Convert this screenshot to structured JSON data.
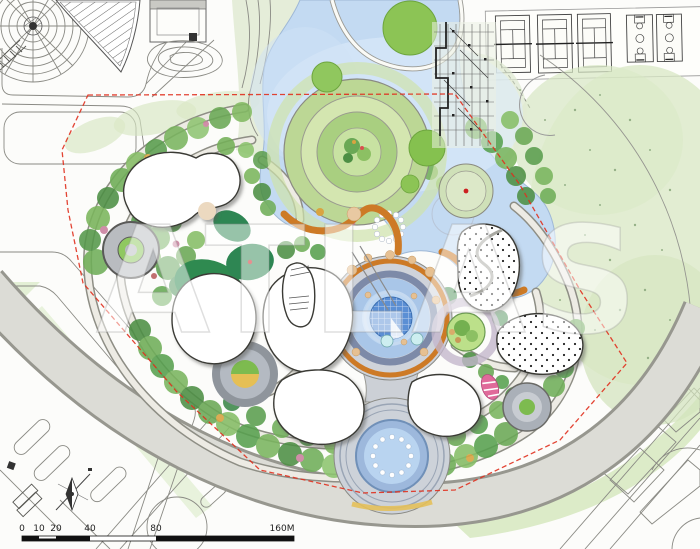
{
  "watermark": {
    "text": "ATLAS"
  },
  "scalebar": {
    "labels": [
      "0",
      "10",
      "20",
      "40",
      "80",
      "160M"
    ]
  },
  "colors": {
    "pond": "#c3daf2",
    "pond_highlight": "#dcebfa",
    "boardwalk": "#cd7a26",
    "boundary": "#e0301e",
    "dome_water": "#5b8fd4",
    "lawn_wash": "#d8e7c4",
    "promenade": "#dcdcd6",
    "dark_lawn": "#2e8653"
  },
  "features": {
    "sports_courts": {
      "tennis_count": 3,
      "basketball_count": 2
    },
    "water_features": [
      "pond",
      "island-ring-garden",
      "central-dome-fountain",
      "south-fountain-plaza"
    ],
    "buildings_pavilions": 7,
    "sand_play_areas": 2
  }
}
